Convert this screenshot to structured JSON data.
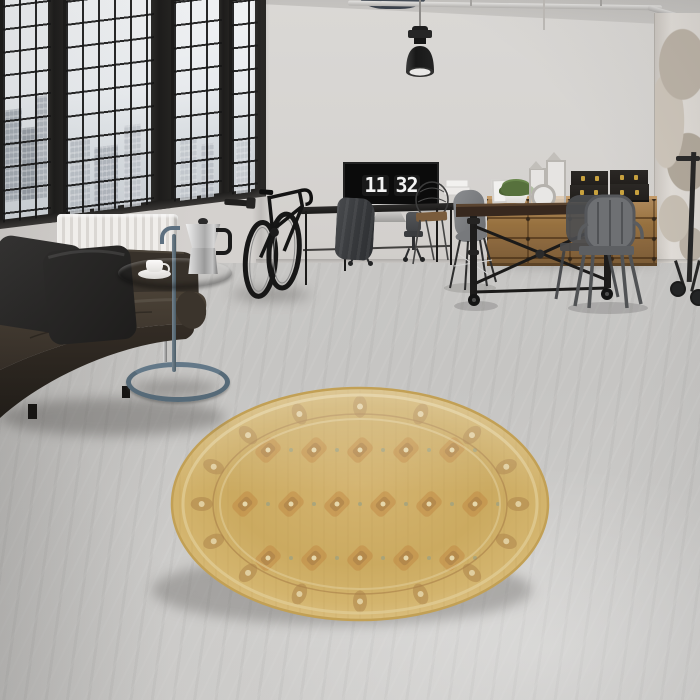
{
  "scene": {
    "name": "industrial-loft-living-room",
    "description": "Photograph of an industrial loft interior: black steel factory windows with a city view, dark leather sofa with grey cushions, blue-grey tray side table holding a moka pot and a coffee cup, wall-mounted bicycle, black console desk with a monitor showing a flip clock, black industrial pendant lamp, ceiling pipe, rustic dining table with grey metal chairs, wooden sideboard with black storage cases and lanterns, distressed plaster column, and a round golden oriental rug on polished concrete flooring."
  },
  "monitor_clock": {
    "hours": "11",
    "minutes": "32"
  },
  "palette": {
    "wall": "#d6d3d0",
    "ceiling": "#c6c4c1",
    "floor": "#cac9c7",
    "window_frame": "#1d1c1b",
    "window_glass": "#e9ecee",
    "radiator": "#edebe8",
    "sofa_leather": "#362f29",
    "cushion": "#292827",
    "side_table": "#5b7080",
    "rug_base": "#cfae66",
    "rug_border": "#a97f48",
    "rug_accent": "#bd7f3b",
    "rug_pale": "#e6d7ab",
    "rug_sage": "#9aa183",
    "wood_sideboard": "#9c7850",
    "table_wood": "#3a2a20",
    "metal_chair": "#6e7073",
    "lamp": "#1f1f1f",
    "box_gold": "#c9a23e",
    "plant": "#57713d"
  },
  "rug": {
    "border_motifs": 16,
    "field_cols": 7,
    "field_rows": 3
  },
  "objects": [
    {
      "name": "factory-window",
      "count": 4
    },
    {
      "name": "pendant-lamp",
      "count": 1
    },
    {
      "name": "ceiling-pipe",
      "count": 1
    },
    {
      "name": "radiator",
      "count": 1
    },
    {
      "name": "leather-sofa",
      "count": 1
    },
    {
      "name": "cushion",
      "count": 2
    },
    {
      "name": "tray-side-table",
      "count": 1
    },
    {
      "name": "moka-pot",
      "count": 1
    },
    {
      "name": "coffee-cup",
      "count": 1
    },
    {
      "name": "wall-mounted-bicycle",
      "count": 1
    },
    {
      "name": "console-desk",
      "count": 1
    },
    {
      "name": "monitor-flip-clock",
      "count": 1
    },
    {
      "name": "office-chair",
      "count": 2
    },
    {
      "name": "draped-jacket",
      "count": 1
    },
    {
      "name": "dining-table",
      "count": 1
    },
    {
      "name": "metal-armchair",
      "count": 2
    },
    {
      "name": "shell-chair",
      "count": 1
    },
    {
      "name": "wire-chair",
      "count": 1
    },
    {
      "name": "sideboard",
      "count": 1
    },
    {
      "name": "storage-case",
      "count": 4
    },
    {
      "name": "potted-plant",
      "count": 1
    },
    {
      "name": "lantern",
      "count": 2
    },
    {
      "name": "picture-frame",
      "count": 2
    },
    {
      "name": "round-oriental-rug",
      "count": 1
    },
    {
      "name": "distressed-column",
      "count": 1
    }
  ]
}
